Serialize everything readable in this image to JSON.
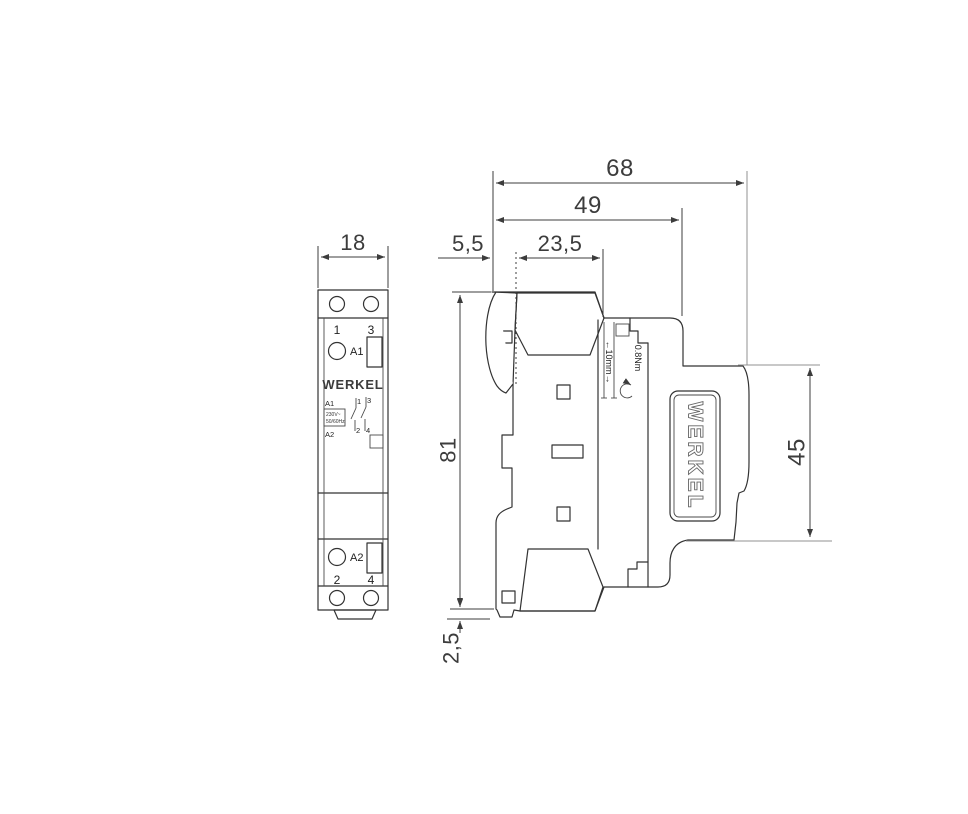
{
  "colors": {
    "line": "#333333",
    "dim_text": "#3c3c3c",
    "brand_gold": "#8c7355",
    "light_line": "#909090"
  },
  "front_view": {
    "width_dim": "18",
    "top_terminal_left": "1",
    "top_terminal_right": "3",
    "coil_top": "A1",
    "coil_bottom": "A2",
    "bottom_terminal_left": "2",
    "bottom_terminal_right": "4",
    "brand": "WERKEL",
    "schematic": {
      "a1": "A1",
      "a2": "A2",
      "voltage": "230V~",
      "frequency": "50/60Hz",
      "c1": "1",
      "c3": "3",
      "c2": "2",
      "c4": "4"
    }
  },
  "side_view": {
    "total_depth": "68",
    "body_depth": "49",
    "rail_offset": "5,5",
    "terminal_depth": "23,5",
    "total_height": "81",
    "front_height": "45",
    "clip_protrusion": "2,5",
    "strip_length": "←10mm→",
    "tightening_torque": "0.8Nm",
    "brand": "WERKEL"
  }
}
